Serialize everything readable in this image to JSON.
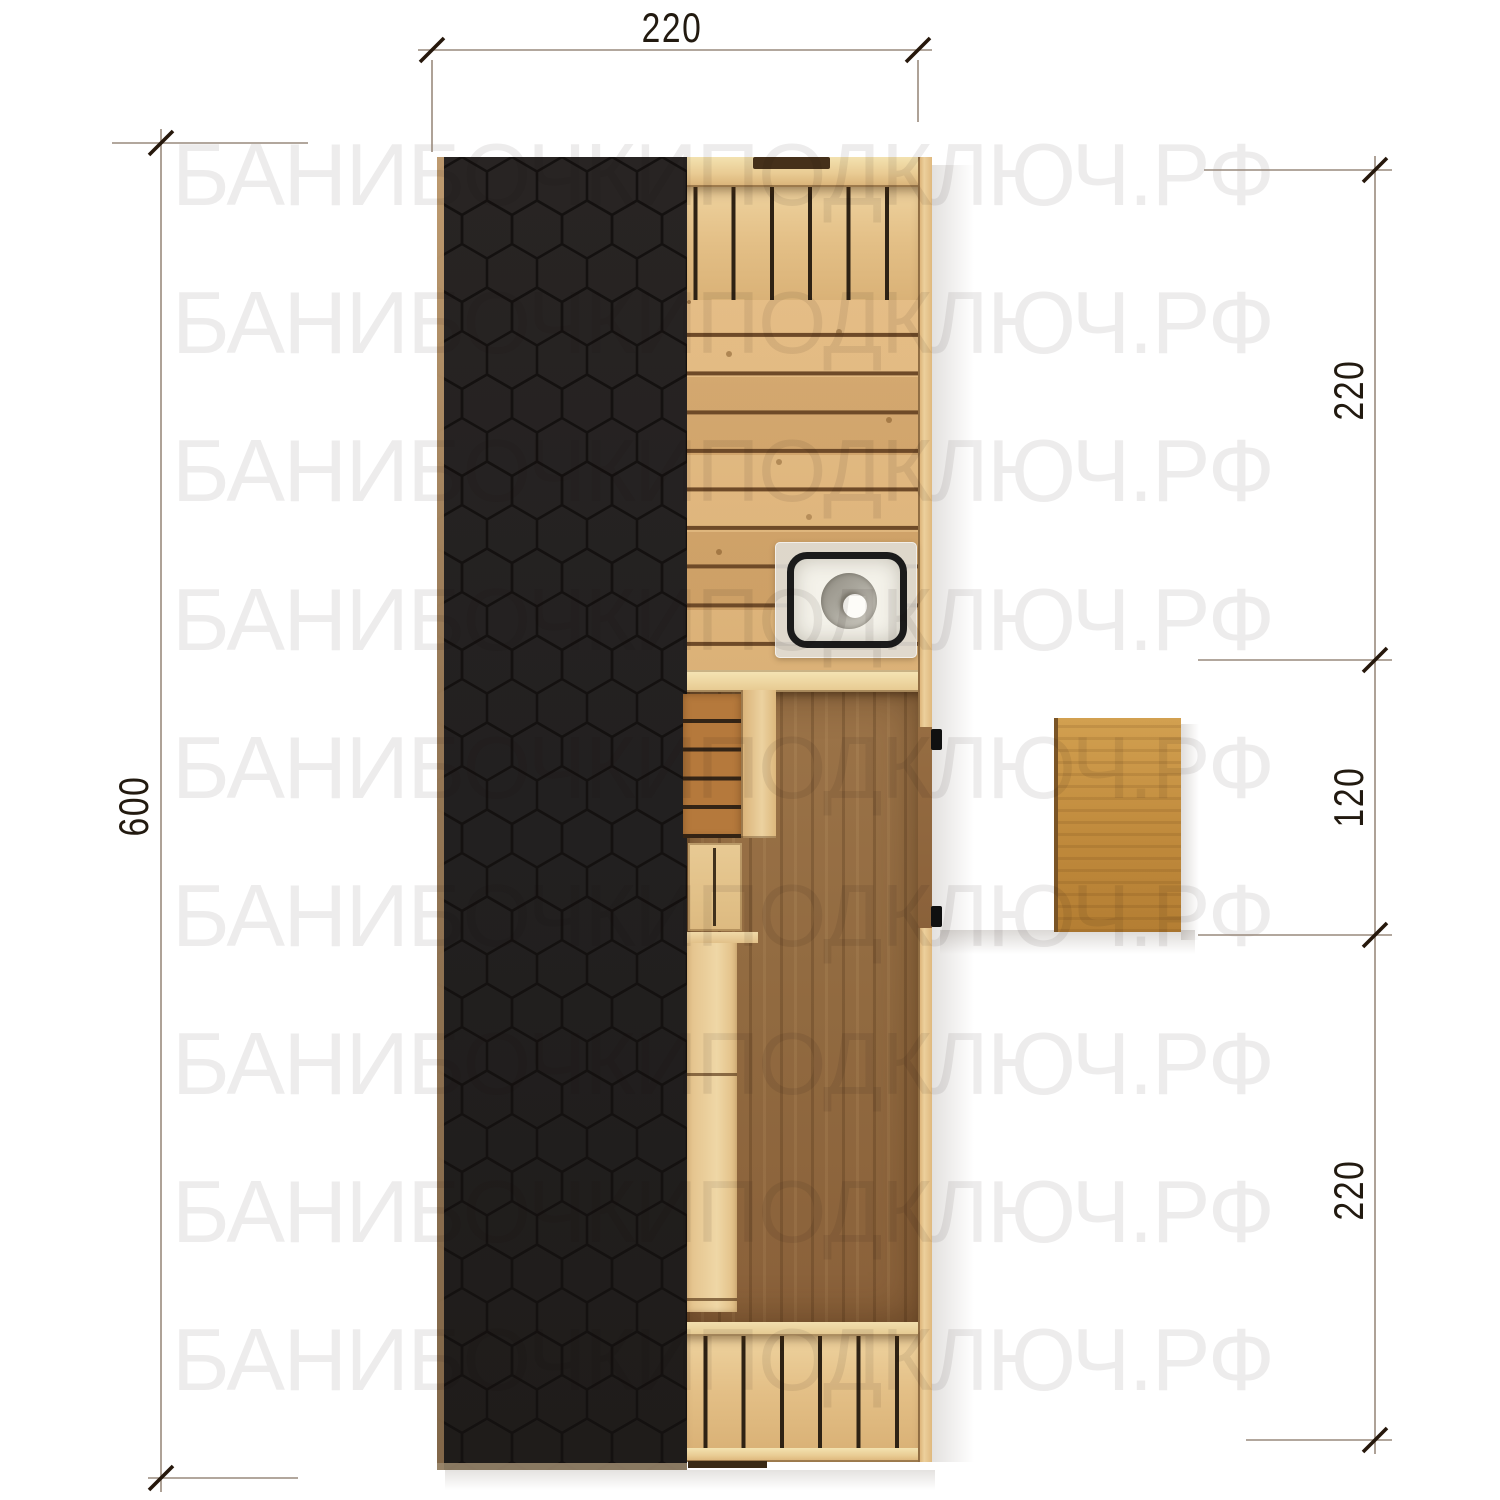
{
  "watermark": {
    "text": "БАНИБОЧКИПОДКЛЮЧ.РФ",
    "rows": 9
  },
  "dimensions": {
    "width_top": "220",
    "height_left": "600",
    "right_top": "220",
    "right_middle": "120",
    "right_bottom": "220"
  },
  "palette": {
    "background": "#ffffff",
    "roof_black": "#232020",
    "roof_hex_line": "#141110",
    "wood_light": "#e9c892",
    "wood_seam_dark": "#6e4a28",
    "plank_floor": "#dcae72",
    "floor_dark_brown": "#966c41",
    "bench_brown": "#b5793c",
    "deck_wood": "#c08a3c",
    "sink_white": "#f4f2ea",
    "sink_border": "#1b1b1b",
    "dimension_line": "#998a7d",
    "dimension_text": "#221a10"
  }
}
